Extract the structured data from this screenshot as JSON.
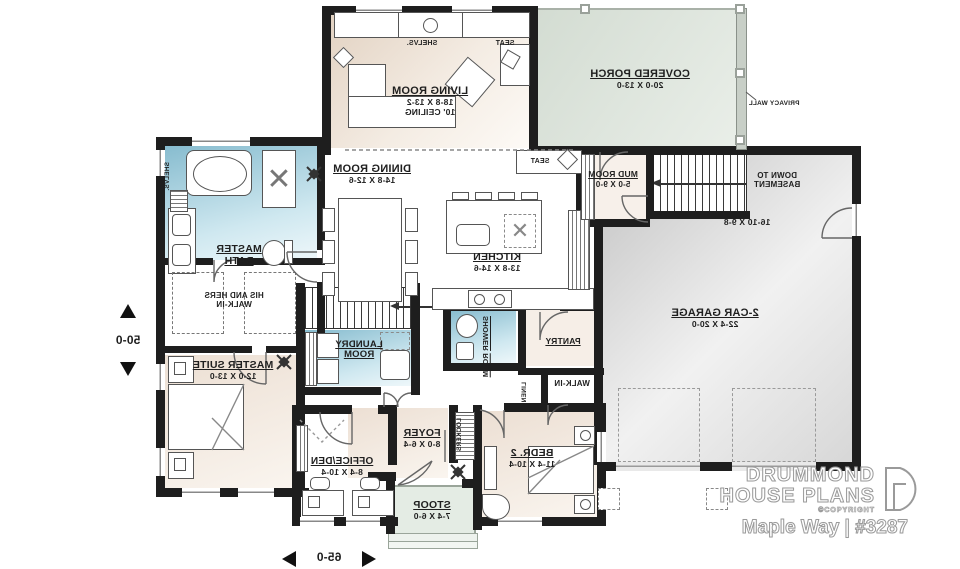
{
  "plan": {
    "rooms": {
      "living": {
        "name": "LIVING ROOM",
        "dims": "18-8 X 13-2",
        "note": "10' CEILING"
      },
      "porch": {
        "name": "COVERED PORCH",
        "dims": "20-0 X 13-0"
      },
      "dining": {
        "name": "DINING ROOM",
        "dims": "14-8 X 12-6"
      },
      "mud": {
        "name": "MUD ROOM",
        "dims": "5-0 X 9-0"
      },
      "garage": {
        "name": "2-CAR GARAGE",
        "dims": "22-4 X 20-0",
        "alcove_dims": "16-10 X 9-8"
      },
      "master_bath": {
        "line1": "MASTER",
        "line2": "BATH"
      },
      "his_hers_walkin": {
        "line1": "HIS AND HERS",
        "line2": "WALK-IN"
      },
      "master_suite": {
        "name": "MASTER SUITE",
        "dims": "12-0 X 13-0"
      },
      "laundry": {
        "line1": "LAUNDRY",
        "line2": "ROOM"
      },
      "kitchen": {
        "name": "KITCHEN",
        "dims": "13-8 X 14-6"
      },
      "shower_room": {
        "line1": "SHOWER",
        "line2": "ROOM"
      },
      "pantry": {
        "name": "PANTRY"
      },
      "linen": {
        "name": "LINEN"
      },
      "walkin_bed2": {
        "name": "WALK-IN"
      },
      "bedroom2": {
        "name": "BEDR. 2",
        "dims": "11-4 X 10-4"
      },
      "foyer": {
        "name": "FOYER",
        "dims": "8-0 X 6-4"
      },
      "lockers": {
        "name": "LOCKERS"
      },
      "office_den": {
        "name": "OFFICE/DEN",
        "dims": "8-4 X 10-4"
      },
      "stoop": {
        "name": "STOOP",
        "dims": "7-4 X 6-0"
      }
    },
    "annotations": {
      "seat": "SEAT",
      "shelves": "SHELVS.",
      "privacy_wall": "PRIVACY WALL",
      "down_to": {
        "line1": "DOWN TO",
        "line2": "BASEMENT"
      }
    },
    "dimensions": {
      "width": "65-0",
      "depth": "50-0"
    },
    "colors": {
      "wall": "#1e1e1e",
      "wood_floor": "#e9dcd0",
      "tile_blue": "#8abccd",
      "porch_green": "#dce4db",
      "garage_gray": "#cccccc"
    }
  },
  "branding": {
    "company_line1": "DRUMMOND",
    "company_line2": "HOUSE PLANS",
    "copyright": "©COPYRIGHT",
    "plan_title": "Maple Way | #3287"
  }
}
